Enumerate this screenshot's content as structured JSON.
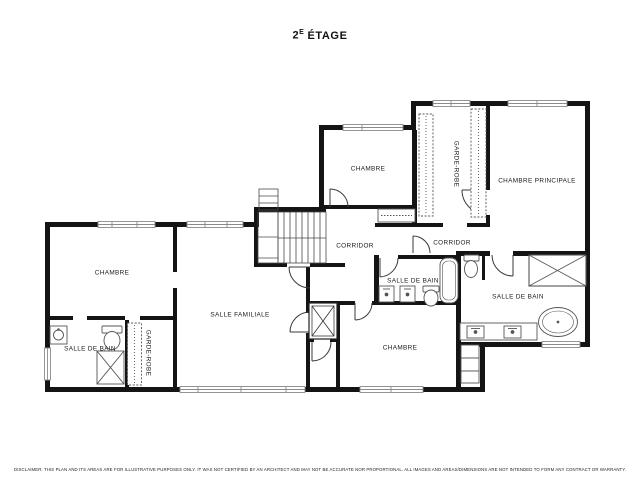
{
  "header": {
    "floor_number": "2",
    "floor_exponent": "E",
    "floor_word": "ÉTAGE"
  },
  "rooms": {
    "chambre_nw": {
      "label": "CHAMBRE"
    },
    "salle_de_bain_w": {
      "label": "SALLE DE BAIN"
    },
    "garde_robe_w": {
      "label": "GARDE-ROBE"
    },
    "salle_familiale": {
      "label": "SALLE FAMILIALE"
    },
    "chambre_n": {
      "label": "CHAMBRE"
    },
    "garde_robe_n": {
      "label": "GARDE-ROBE"
    },
    "chambre_principale": {
      "label": "CHAMBRE PRINCIPALE"
    },
    "corridor_west": {
      "label": "CORRIDOR"
    },
    "corridor_east": {
      "label": "CORRIDOR"
    },
    "salle_de_bain_centre": {
      "label": "SALLE DE BAIN"
    },
    "chambre_s": {
      "label": "CHAMBRE"
    },
    "salle_de_bain_est": {
      "label": "SALLE DE BAIN"
    }
  },
  "footer": {
    "disclaimer": "DISCLAIMER: THIS PLAN AND ITS AREAS ARE FOR ILLUSTRATIVE PURPOSES ONLY. IT WAS NOT CERTIFIED BY AN ARCHITECT AND MAY NOT BE ACCURATE NOR PROPORTIONAL. ALL IMAGES AND AREAS/DIMENSIONS ARE NOT INTENDED TO FORM ANY CONTRACT OR WARRANTY."
  },
  "colors": {
    "wall": "#141414",
    "window_frame": "#8a8a8a",
    "fixture": "#555555",
    "stair": "#4a4a4a",
    "label_text": "#1a1a1a"
  }
}
